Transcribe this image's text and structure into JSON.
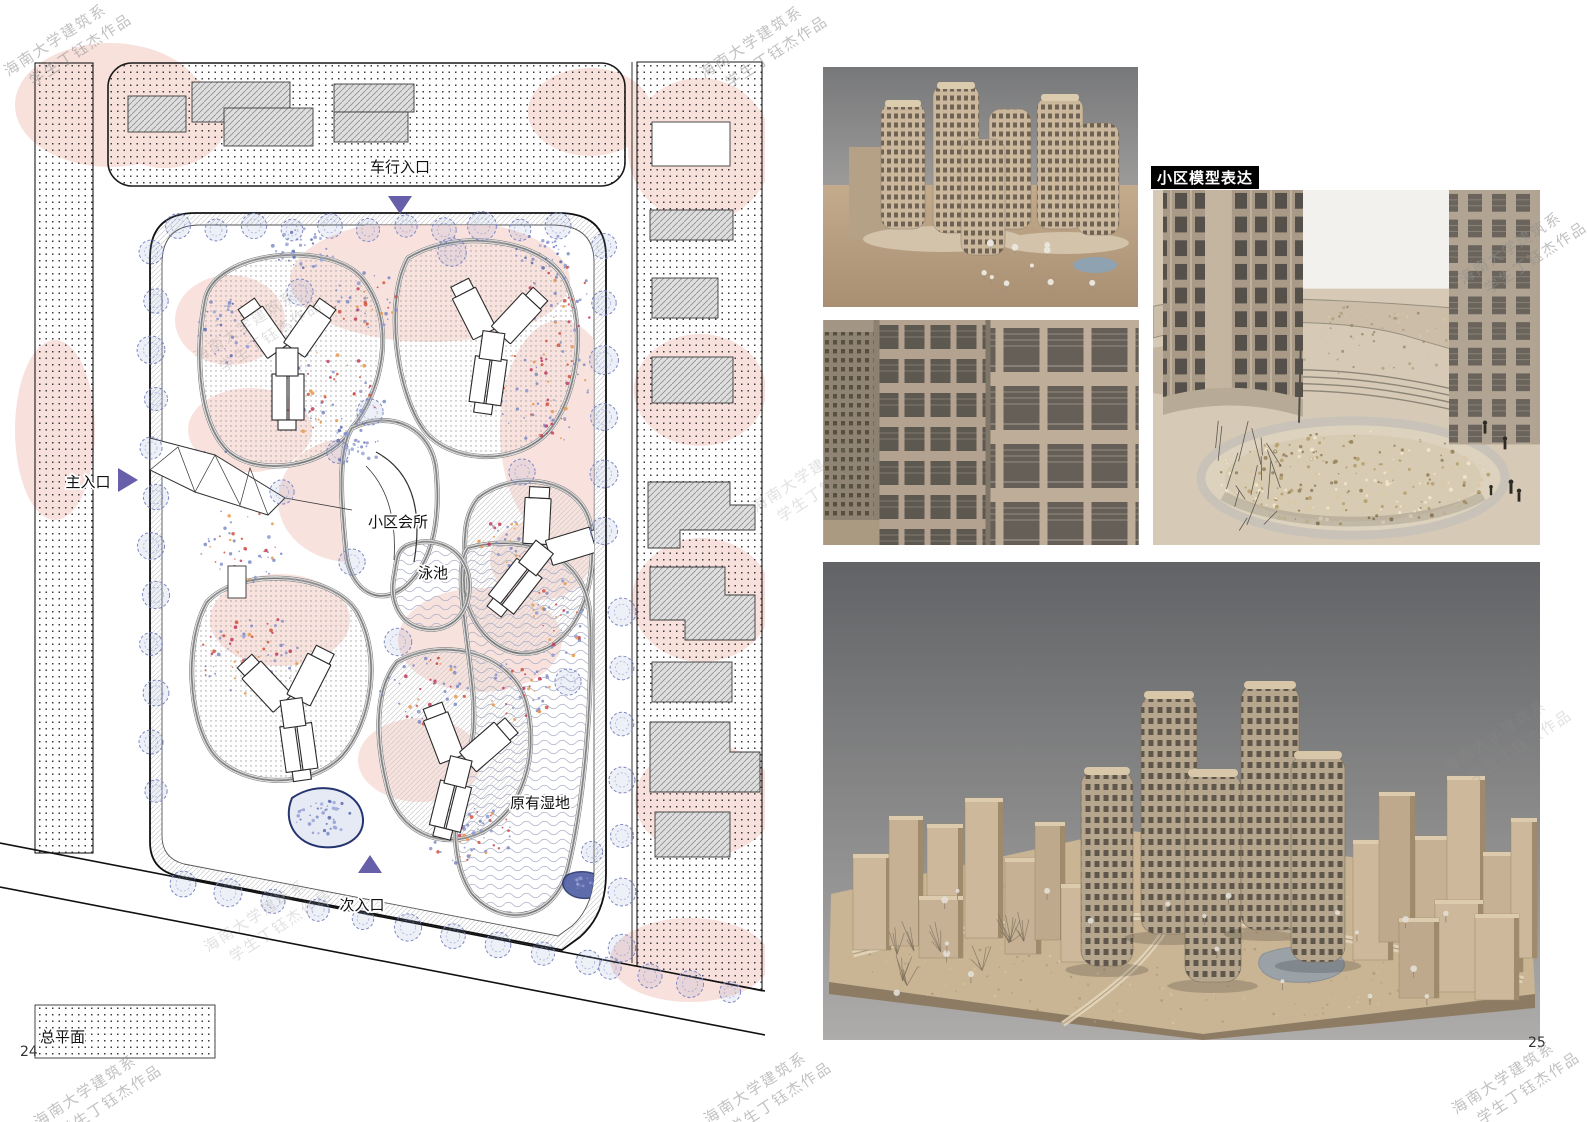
{
  "pages": {
    "left_number": "24",
    "right_number": "25"
  },
  "watermark": {
    "line1": "海南大学建筑系",
    "line2": "学生丁钰杰作品"
  },
  "plan": {
    "caption": "总平面",
    "labels": {
      "vehicle_entrance": "车行入口",
      "main_entrance": "主入口",
      "clubhouse": "小区会所",
      "pool": "泳池",
      "wetland": "原有湿地",
      "secondary_entrance": "次入口"
    },
    "colors": {
      "entrance_arrow": "#675fa9",
      "pink_zone": "#f6d6d0",
      "tree_outline": "#7d88c4",
      "pond_outline": "#26356f"
    }
  },
  "model": {
    "section_title": "小区模型表达"
  }
}
